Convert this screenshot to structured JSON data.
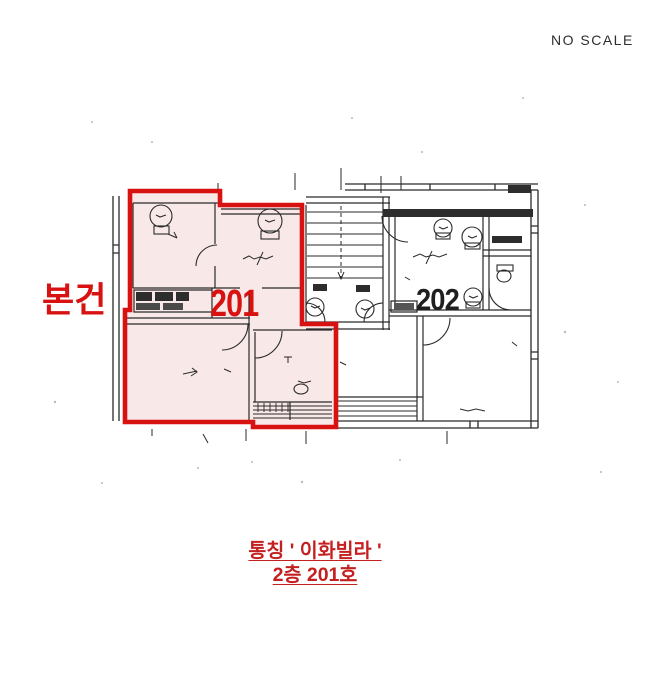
{
  "header": {
    "no_scale": "NO SCALE"
  },
  "plan": {
    "subject_marker": "본건",
    "unit_left": "201",
    "unit_right": "202"
  },
  "caption": {
    "line1": "통칭 ' 이화빌라 '",
    "line2": "2층 201호"
  },
  "colors": {
    "highlight_stroke": "#d81111",
    "highlight_fill": "#f9e8e8",
    "caption_red": "#c42020",
    "ink": "#2a2a2a"
  }
}
